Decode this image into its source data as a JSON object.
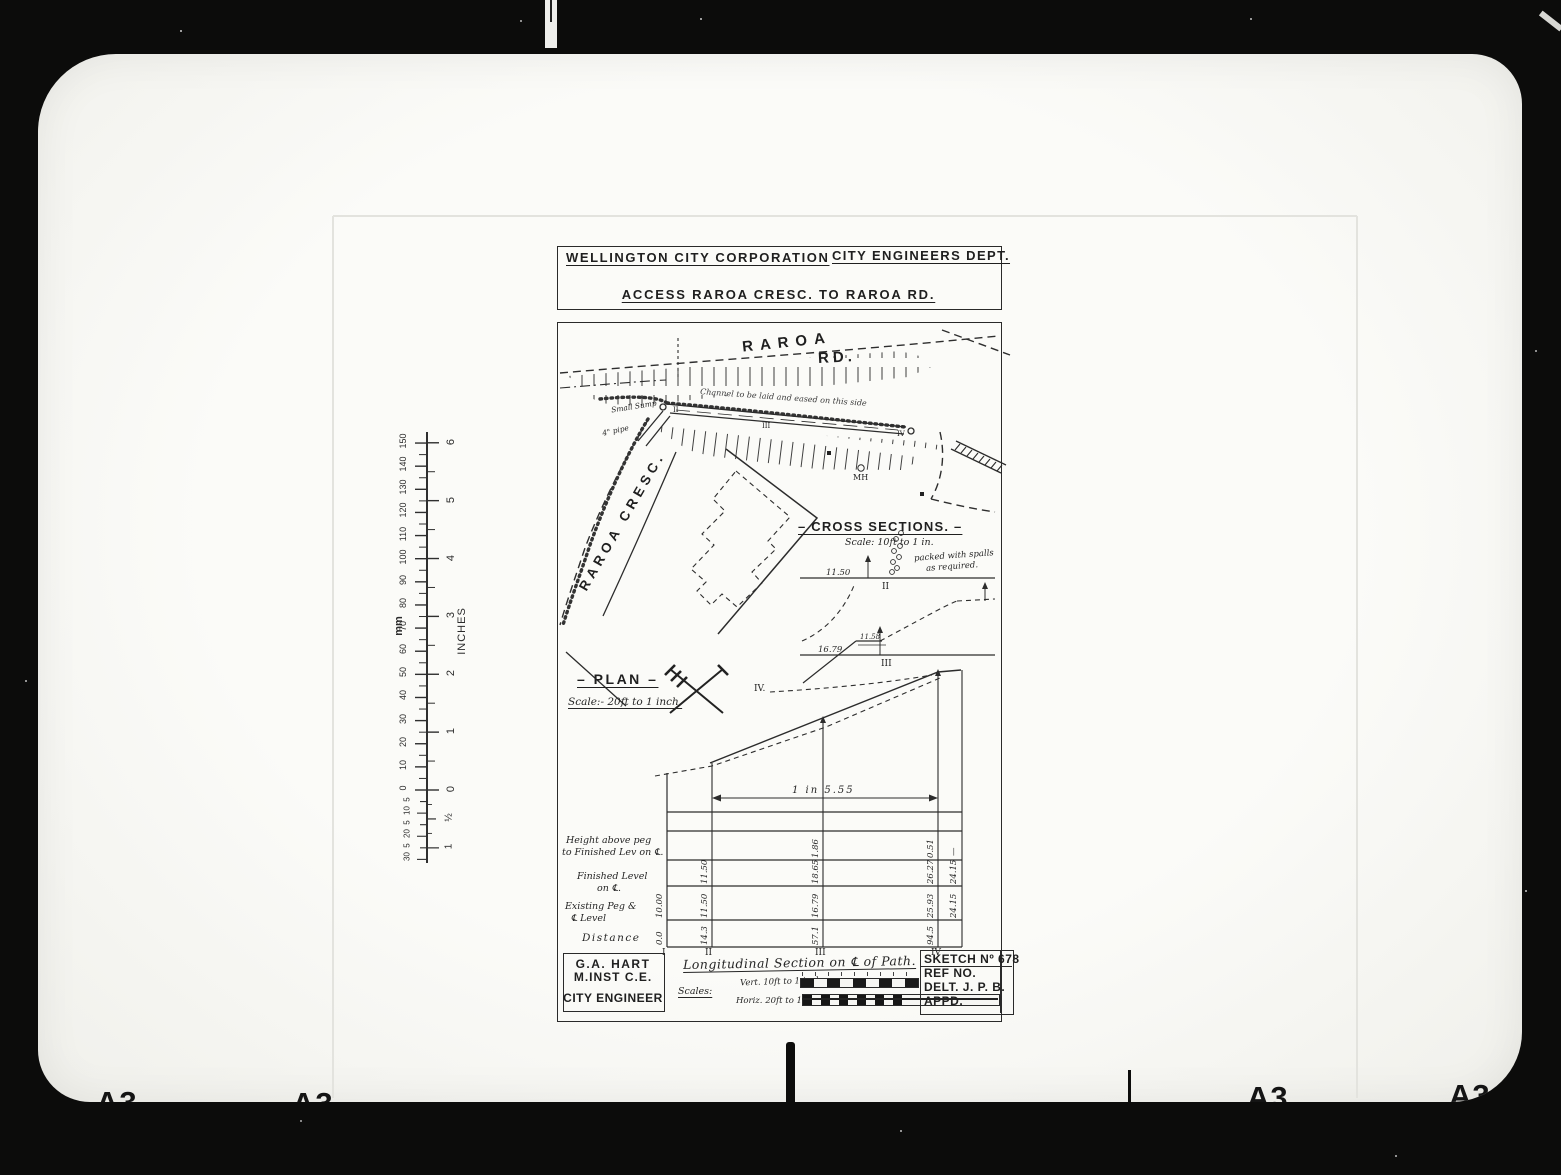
{
  "film": {
    "a3_marks": [
      "A3",
      "A3",
      "A3",
      "A3"
    ]
  },
  "header": {
    "org": "WELLINGTON CITY CORPORATION",
    "dept": "CITY ENGINEERS DEPT.",
    "title": "ACCESS  RAROA  CRESC.  TO  RAROA  RD."
  },
  "plan": {
    "label": "– PLAN –",
    "scale": "Scale:- 20ft to 1 inch.",
    "road_1": "RAROA",
    "road_2": "RD.",
    "crescent": "RAROA CRESC.",
    "channel_note": "Channel to be laid and eased on this side",
    "sump_note": "Small Sump",
    "pipe_note": "4\" pipe",
    "manhole": "MH",
    "marks": {
      "s2": "II",
      "s3": "III",
      "s4": "IV"
    }
  },
  "cross_sections": {
    "heading": "– CROSS SECTIONS. –",
    "scale": "Scale: 10ft to 1 in.",
    "s2": {
      "level": "11.50",
      "numeral": "II",
      "note_line1": "packed with spalls",
      "note_line2": "as required."
    },
    "s3": {
      "level": "16.79",
      "numeral": "III",
      "offset": "11.58"
    },
    "s4_label": "IV."
  },
  "long_section": {
    "grade": "1 in 5.55",
    "row_labels": {
      "height_l1": "Height above peg",
      "height_l2": "to Finished Lev on ℄.",
      "finished_l1": "Finished Level",
      "finished_l2": "on ℄.",
      "existing_l1": "Existing Peg &",
      "existing_l2": "℄ Level",
      "distance": "Distance"
    },
    "stations": [
      "I",
      "II",
      "III",
      "IV"
    ],
    "table": {
      "height": [
        "",
        "",
        "1.86",
        "0.51",
        "—"
      ],
      "finished": [
        "",
        "11.50",
        "18.65",
        "26.27",
        "24.15"
      ],
      "existing": [
        "10.00",
        "11.50",
        "16.79",
        "25.93",
        "24.15"
      ],
      "distance": [
        "0.0",
        "14.3",
        "57.1",
        "94.5",
        ""
      ]
    }
  },
  "footer": {
    "engineer_line1": "G.A. HART",
    "engineer_line2": "M.INST C.E.",
    "engineer_line3": "CITY ENGINEER",
    "section_title": "Longitudinal Section on ℄ of Path.",
    "scales_label": "Scales:",
    "vert_scale": "Vert. 10ft to 1 inch",
    "horiz_scale": "Horiz. 20ft to 1 inch",
    "sketch_no": "SKETCH Nº 678",
    "ref_no": "REF NO.",
    "delt": "DELT.  J. P. B.",
    "appd": "APPD."
  },
  "ruler": {
    "mm_label": "mm",
    "inches_label": "INCHES",
    "mm_majors": [
      0,
      10,
      20,
      30,
      40,
      50,
      60,
      70,
      80,
      90,
      100,
      110,
      120,
      130,
      140,
      150
    ],
    "mm_sub": [
      "5",
      "10",
      "5",
      "20",
      "5",
      "30"
    ],
    "inch_majors": [
      "0",
      "1",
      "2",
      "3",
      "4",
      "5",
      "6"
    ],
    "inch_sub": [
      "½",
      "1"
    ]
  }
}
